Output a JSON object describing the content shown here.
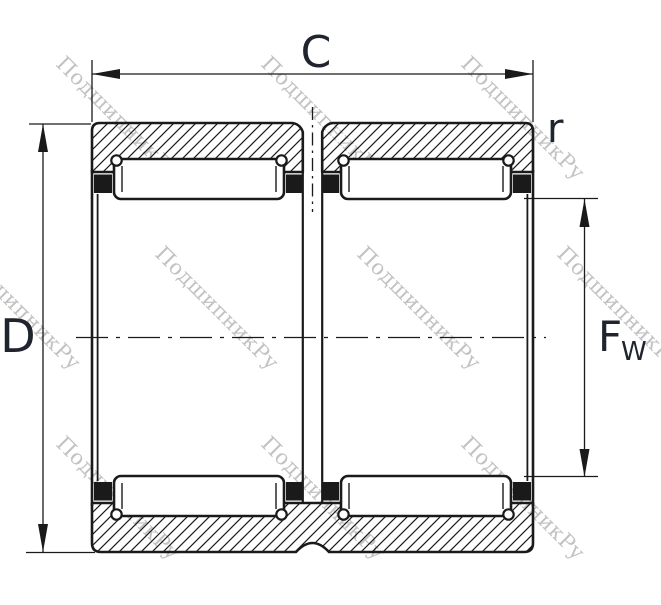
{
  "drawing": {
    "description_labels": {
      "outer_width": "C",
      "outer_diameter": "D",
      "corner_radius": "r",
      "bore_main": "F",
      "bore_sub": "W"
    },
    "watermark": {
      "text": "ПодшипникРу"
    },
    "colors": {
      "line": "#1a1a1a",
      "label": "#20242e",
      "watermark": "#c2c2c2",
      "background": "#ffffff"
    }
  }
}
